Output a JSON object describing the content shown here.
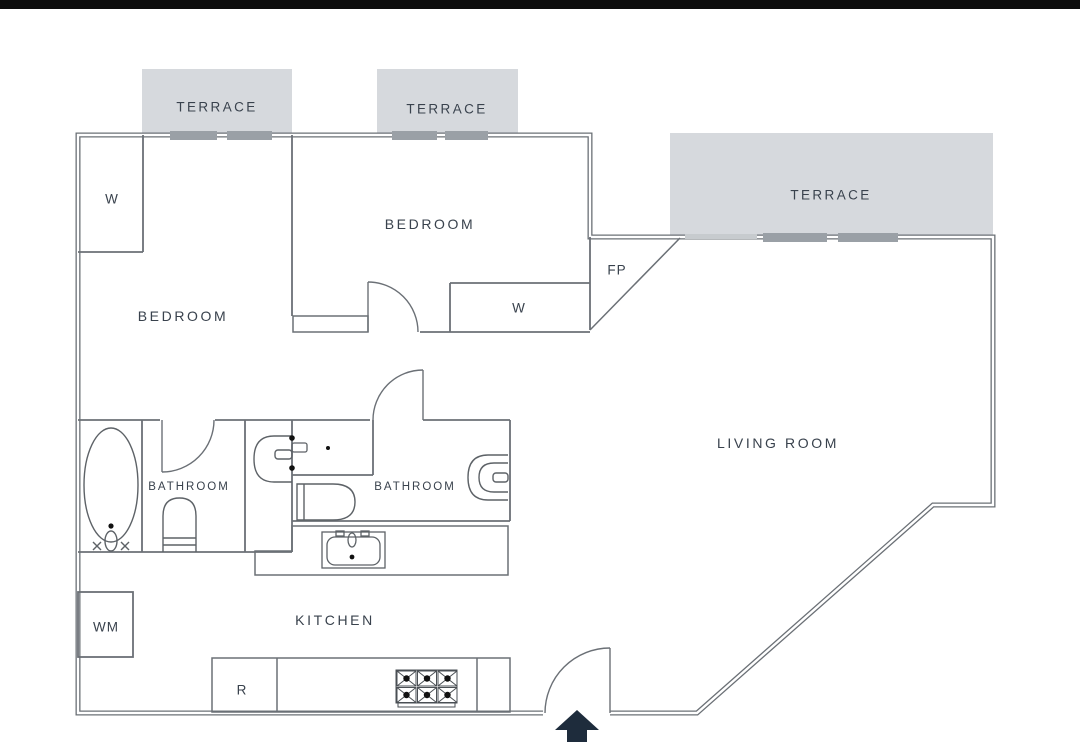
{
  "plan": {
    "title": "Apartment floor plan",
    "terraces": {
      "terrace1": "TERRACE",
      "terrace2": "TERRACE",
      "terrace3": "TERRACE"
    },
    "rooms": {
      "bedroom1": "BEDROOM",
      "bedroom2": "BEDROOM",
      "living_room": "LIVING ROOM",
      "bathroom1": "BATHROOM",
      "bathroom2": "BATHROOM",
      "kitchen": "KITCHEN"
    },
    "tags": {
      "wardrobe1": "W",
      "wardrobe2": "W",
      "fireplace": "FP",
      "washing_machine": "WM",
      "refrigerator": "R"
    },
    "colors": {
      "wall": "#6b7076",
      "terrace_fill": "#d6d9dd",
      "window_bar": "#9aa0a6",
      "window_bar_light": "#c7cbce",
      "label_text": "#39424d",
      "entrance_arrow": "#1e2c3c",
      "top_strip": "#0d0d0d"
    }
  }
}
